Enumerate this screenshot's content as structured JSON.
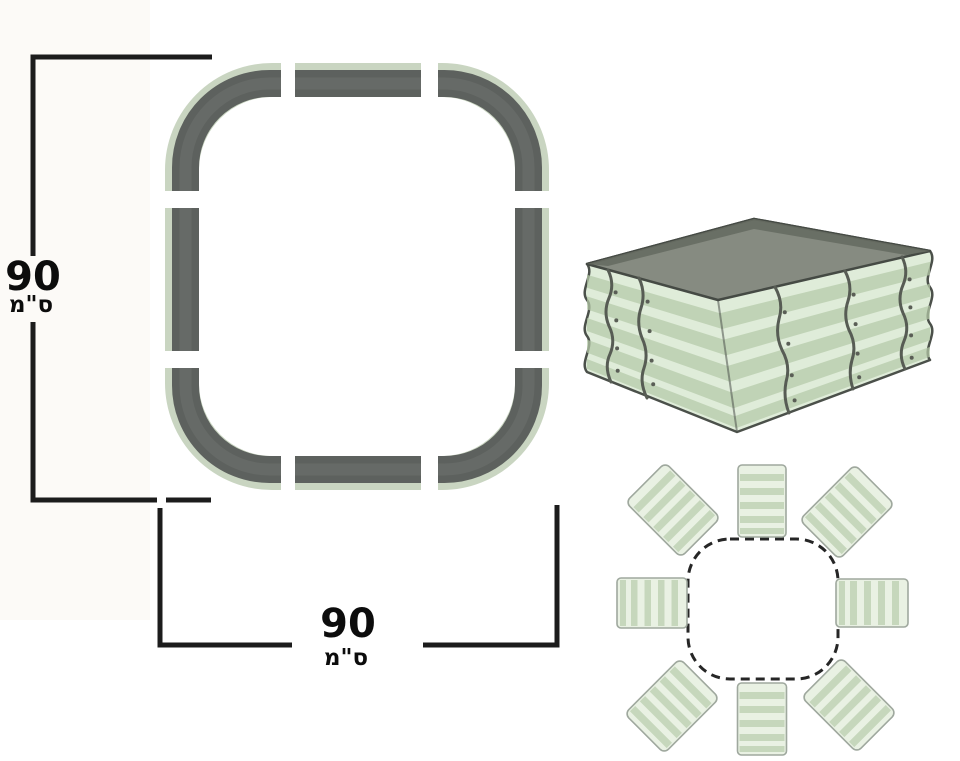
{
  "page": {
    "type": "product-dimensions-diagram",
    "background": "#ffffff"
  },
  "dimensions": {
    "side_a": {
      "value": "90",
      "unit": "ס\"מ",
      "orientation": "vertical"
    },
    "side_b": {
      "value": "90",
      "unit": "ס\"מ",
      "orientation": "horizontal"
    }
  },
  "views": {
    "top_view_frame": {
      "description": "rounded-square frame top view",
      "segments": 8,
      "corner_pieces": 4,
      "straight_pieces": 4
    },
    "assembled_view": {
      "description": "corrugated raised garden bed, assembled 3D view"
    },
    "exploded_view": {
      "description": "8 corrugated panels arranged around dashed assembled outline",
      "panels": 8
    }
  },
  "colors": {
    "frame_gray": "#5d615e",
    "frame_green_edge": "#c9d5c1",
    "bed_green_light": "#dfecd9",
    "bed_green_stripe": "#b4c9a8",
    "bed_interior_gray": "#868b81",
    "panel_fill": "#e9f1e3",
    "panel_stripe": "#bdd1b2",
    "dimension_line": "#1c1c1c",
    "text": "#0c0c0c"
  }
}
